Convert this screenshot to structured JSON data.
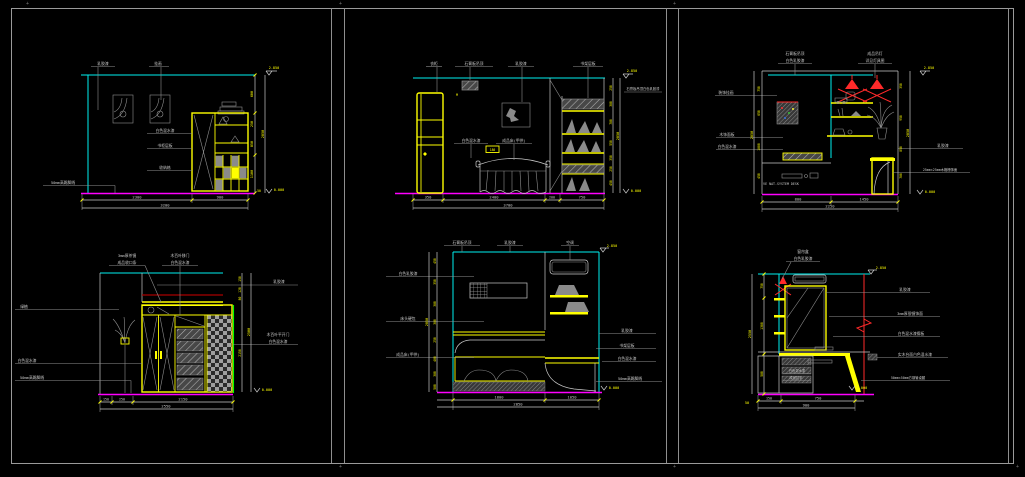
{
  "sheet": {
    "corner_mark": "+"
  },
  "colors": {
    "cyan": "#00f0f0",
    "magenta": "#ff00ff",
    "yellow": "#ffff00",
    "red": "#ff2a2a",
    "dark_red": "#a80000",
    "green": "#00ff00",
    "gray": "#8f8f8f",
    "white": "#c9c9c9",
    "background": "#000000"
  },
  "p1": {
    "top1": "乳胶漆",
    "top2": "挂画",
    "m1": "白色混水漆",
    "m2": "书柜层板",
    "m3": "收纳格",
    "left1": "50mm高踢脚线",
    "b1": "2300",
    "b2": "900",
    "bt": "3200",
    "r1": "600",
    "r2": "250",
    "r3": "850",
    "r4": "1100",
    "r5": "50",
    "rt": "2850",
    "lv_top": "2.850",
    "lv_bot": "0.000"
  },
  "p2": {
    "top1": "衣柜",
    "top2": "石膏板吊顶",
    "top3": "乳胶漆",
    "top4": "书架层板",
    "m1": "白色混水漆",
    "m2": "成品床(甲供)",
    "m3": "180",
    "mark": "M",
    "right_note": "石膏板吊顶白色乳胶漆",
    "r1": "250",
    "r2": "300",
    "r3": "700",
    "r4": "550",
    "r5": "350",
    "r6": "250",
    "r7": "450",
    "rt": "2850",
    "b1": "350",
    "b2": "2400",
    "b3": "200",
    "b4": "750",
    "bt": "3700",
    "lv_top": "2.850",
    "lv_bot": "0.000"
  },
  "p3": {
    "top1a": "石膏板吊顶",
    "top1b": "白色乳胶漆",
    "top2a": "成品吊灯",
    "top2b": "详见灯具图",
    "left1": "装饰挂画",
    "left2": "木饰面板",
    "left3": "白色混水漆",
    "right1": "乳胶漆",
    "right2": "25mm×25mm木格栅饰面",
    "brand": "VE NAT-SYSTEM DESK",
    "ld1": "750",
    "ld2": "650",
    "ld3": "1000",
    "ld4": "450",
    "ldt": "2850",
    "r1": "350",
    "r2": "950",
    "r3": "850",
    "r4": "700",
    "rt": "2850",
    "b1": "800",
    "b2": "1450",
    "bt": "2250",
    "lv_top": "2.850",
    "lv_bot": "0.000"
  },
  "p4": {
    "top1a": "3mm厚茶镜",
    "top1b": "成品收口条",
    "top2a": "木百叶移门",
    "top2b": "白色混水漆",
    "left1": "绿植",
    "left2": "白色混水漆",
    "left3": "50mm高踢脚线",
    "right_note": "乳胶漆",
    "right1a": "木百叶平开门",
    "right1b": "白色混水漆",
    "r1": "150",
    "r2": "120",
    "r3": "80",
    "r4": "2150",
    "rt": "2500",
    "b1": "150",
    "b2": "250",
    "b3": "2150",
    "bt": "2550",
    "lv_bot": "0.000"
  },
  "p5": {
    "top1": "石膏板吊顶",
    "top2": "乳胶漆",
    "top3": "空调",
    "left1": "白色乳胶漆",
    "left2": "床头硬包",
    "left3": "成品床(甲供)",
    "right1": "乳胶漆",
    "right2": "书架层板",
    "right3": "白色混水漆",
    "right4": "50mm高踢脚线",
    "ld1": "450",
    "ld2": "350",
    "ld3": "300",
    "ld4": "300",
    "ld5": "250",
    "ld6": "400",
    "ld7": "300",
    "ld8": "500",
    "ldt": "2850",
    "b1": "1800",
    "b2": "1050",
    "bt": "2850",
    "lv_top": "2.850",
    "lv_bot": "0.000"
  },
  "p6": {
    "top1": "窗帘盒",
    "top2": "白色乳胶漆",
    "right1": "乳胶漆",
    "right2": "3mm厚银镜饰面",
    "right3": "白色混水漆搁板",
    "right4": "实木台面白色混水漆",
    "right5": "50mm×50mm方钢管桌腿",
    "in1": "白色混水漆",
    "in2": "成品拉手",
    "ld1": "750",
    "ld2": "1300",
    "ld3": "500",
    "ldt": "2550",
    "b0": "50",
    "b1": "150",
    "b2": "750",
    "bt": "900",
    "lv_top": "2.850",
    "lv_bot": "0.000"
  }
}
